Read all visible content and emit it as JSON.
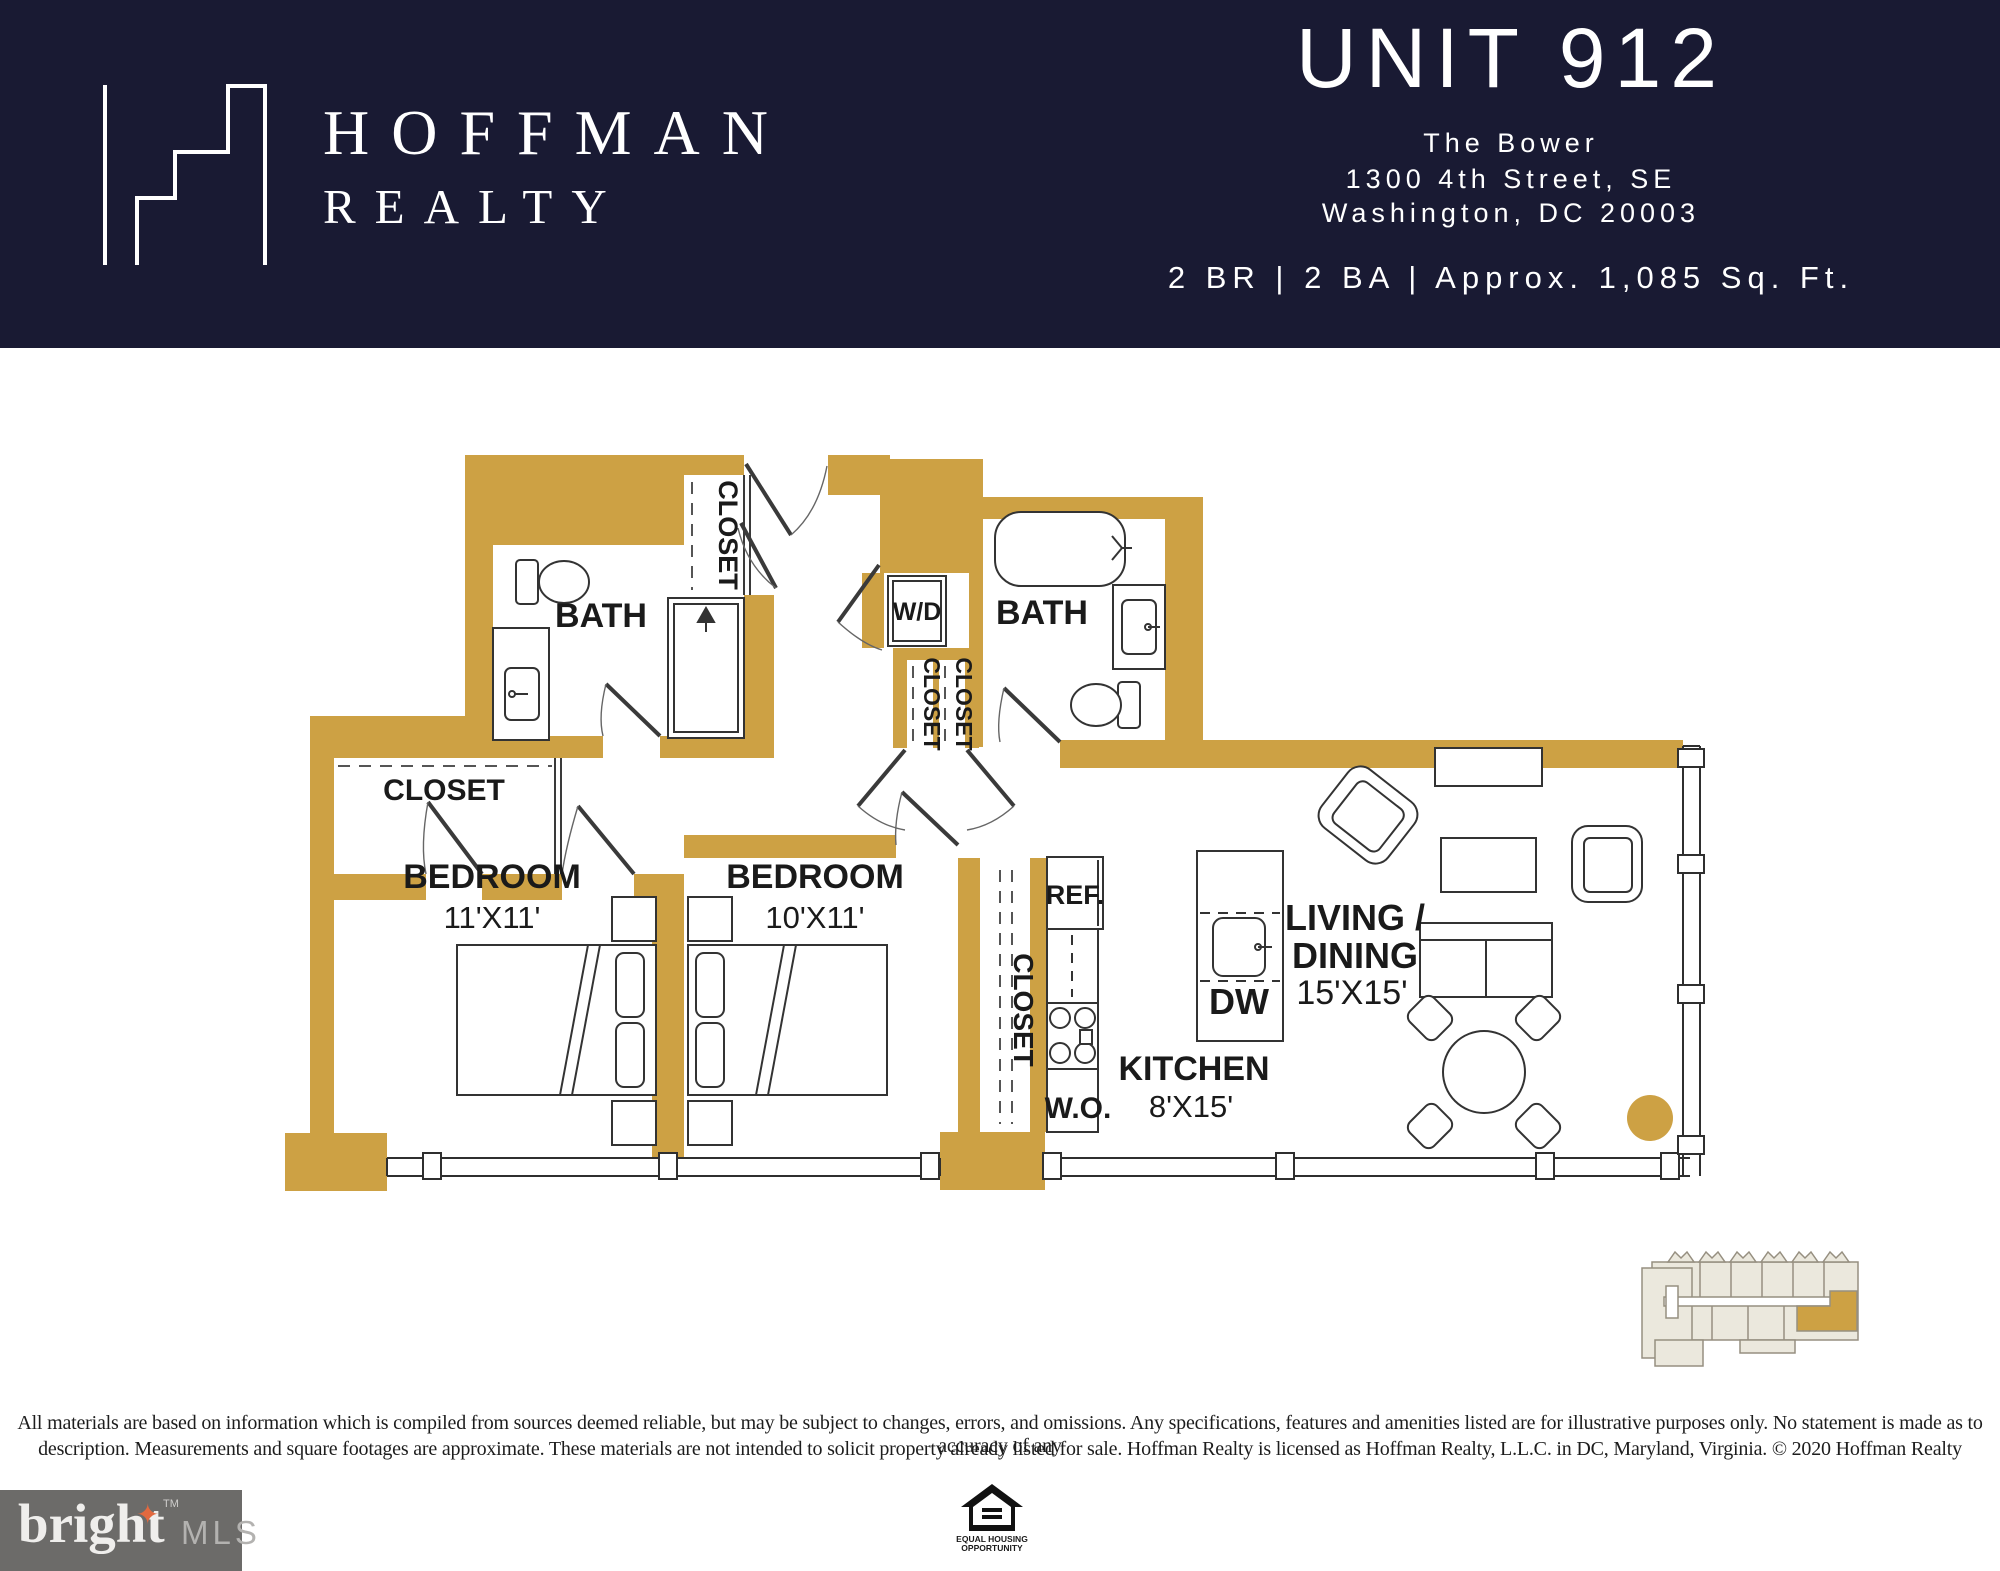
{
  "header": {
    "bg_color": "#191a33",
    "brand_line1": "HOFFMAN",
    "brand_line2": "REALTY",
    "unit_title": "UNIT 912",
    "building_name": "The Bower",
    "address_line1": "1300 4th Street, SE",
    "address_line2": "Washington, DC 20003",
    "specs_line": "2 BR | 2 BA | Approx. 1,085 Sq. Ft."
  },
  "floor_plan": {
    "wall_color": "#cda144",
    "line_color": "#333333",
    "labels": {
      "bath1": "BATH",
      "bath2": "BATH",
      "closet_entry": "CLOSET",
      "closet_mid1": "CLOSET",
      "closet_mid2": "CLOSET",
      "closet_walkin": "CLOSET",
      "closet_hall": "CLOSET",
      "wd": "W/D",
      "ref": "REF.",
      "dw": "DW",
      "wo": "W.O.",
      "bedroom1_name": "BEDROOM",
      "bedroom1_dims": "11'X11'",
      "bedroom2_name": "BEDROOM",
      "bedroom2_dims": "10'X11'",
      "kitchen_name": "KITCHEN",
      "kitchen_dims": "8'X15'",
      "living_line1": "LIVING /",
      "living_line2": "DINING",
      "living_dims": "15'X15'"
    }
  },
  "footer": {
    "disclaimer_line1": "All materials are based on information which is compiled from sources deemed reliable, but may be subject to changes, errors, and omissions. Any specifications, features and amenities listed are for illustrative purposes only. No statement is made as to accuracy of any",
    "disclaimer_line2": "description. Measurements and square footages are approximate. These materials are not intended to solicit property already listed for sale. Hoffman Realty is licensed as Hoffman Realty, L.L.C. in DC, Maryland, Virginia. © 2020 Hoffman Realty",
    "bright_logo": {
      "word": "bright",
      "star": "✦",
      "tm": "TM",
      "suffix": "MLS"
    },
    "equal_housing": {
      "line1": "EQUAL HOUSING",
      "line2": "OPPORTUNITY"
    }
  }
}
